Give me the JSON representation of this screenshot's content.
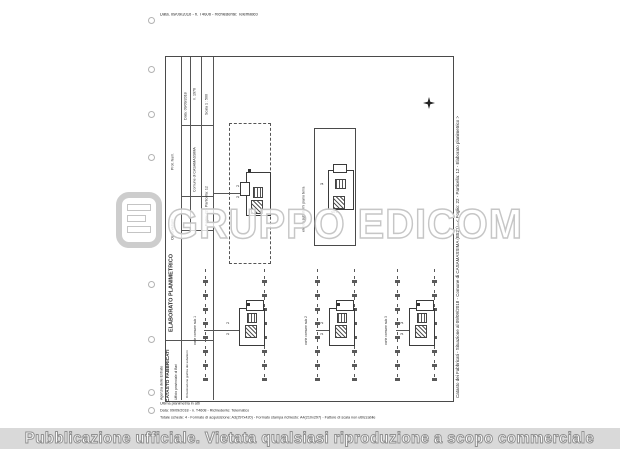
{
  "document": {
    "top_line": "Data. 09/09/2018 - n. T4608 - Richiedente: Telematico",
    "footer": {
      "line1": "Ultima planimetria in atti",
      "line2": "Data: 09/09/2018 - n. T4608 - Richiedente: Telematico",
      "line3": "Totale schede: 4 - Formato di acquisizione: A3(297x420)  - Formato stampa richiesto: A4(210x297) - Fattore di scala non utilizzabile"
    },
    "right_caption": "Catasto dei Fabbricati - Situazione al 09/09/2018 - Comune di CASAMASSIMA (B521) - < Foglio: 22 - Particella: 12 - Elaborato planimetrico >",
    "stamp": {
      "line1": "Agenzia delle Entrate",
      "line2": "CATASTO FABBRICATI",
      "line3": "Ufficio provinciale di Bari"
    }
  },
  "header_strip": {
    "title": "ELABORATO PLANIMETRICO",
    "prot": "Prot. Num.",
    "num": "n. 1976",
    "date": "Data: 09/09/2018",
    "scale": "Scala 1 : 500",
    "comune": "Comune di CASAMASSIMA",
    "foglio": "Foglio: 22 - Particella: 12",
    "sub": "Dimostrazione grafica dei subalterni",
    "note": "Osservazioni"
  },
  "drawing": {
    "between_label": "elenco subalterni piano terra",
    "plan_upper_left": {
      "n1": "71",
      "n2": "72"
    },
    "plan_upper_right": {
      "side_label": "78",
      "sub_label": "SU.2"
    },
    "bays": [
      {
        "label": "corte comune sub 1",
        "n1": "71",
        "n2": "72"
      },
      {
        "label": "corte comune sub 2",
        "n1": "73",
        "n2": "74"
      },
      {
        "label": "corte comune sub 3",
        "n1": "75",
        "n2": "76"
      }
    ]
  },
  "watermark": {
    "brand": "GRUPPO EDICOM",
    "publication_notice": "Pubblicazione ufficiale. Vietata qualsiasi riproduzione a scopo commerciale",
    "accent_color": "#c6c6c6"
  }
}
